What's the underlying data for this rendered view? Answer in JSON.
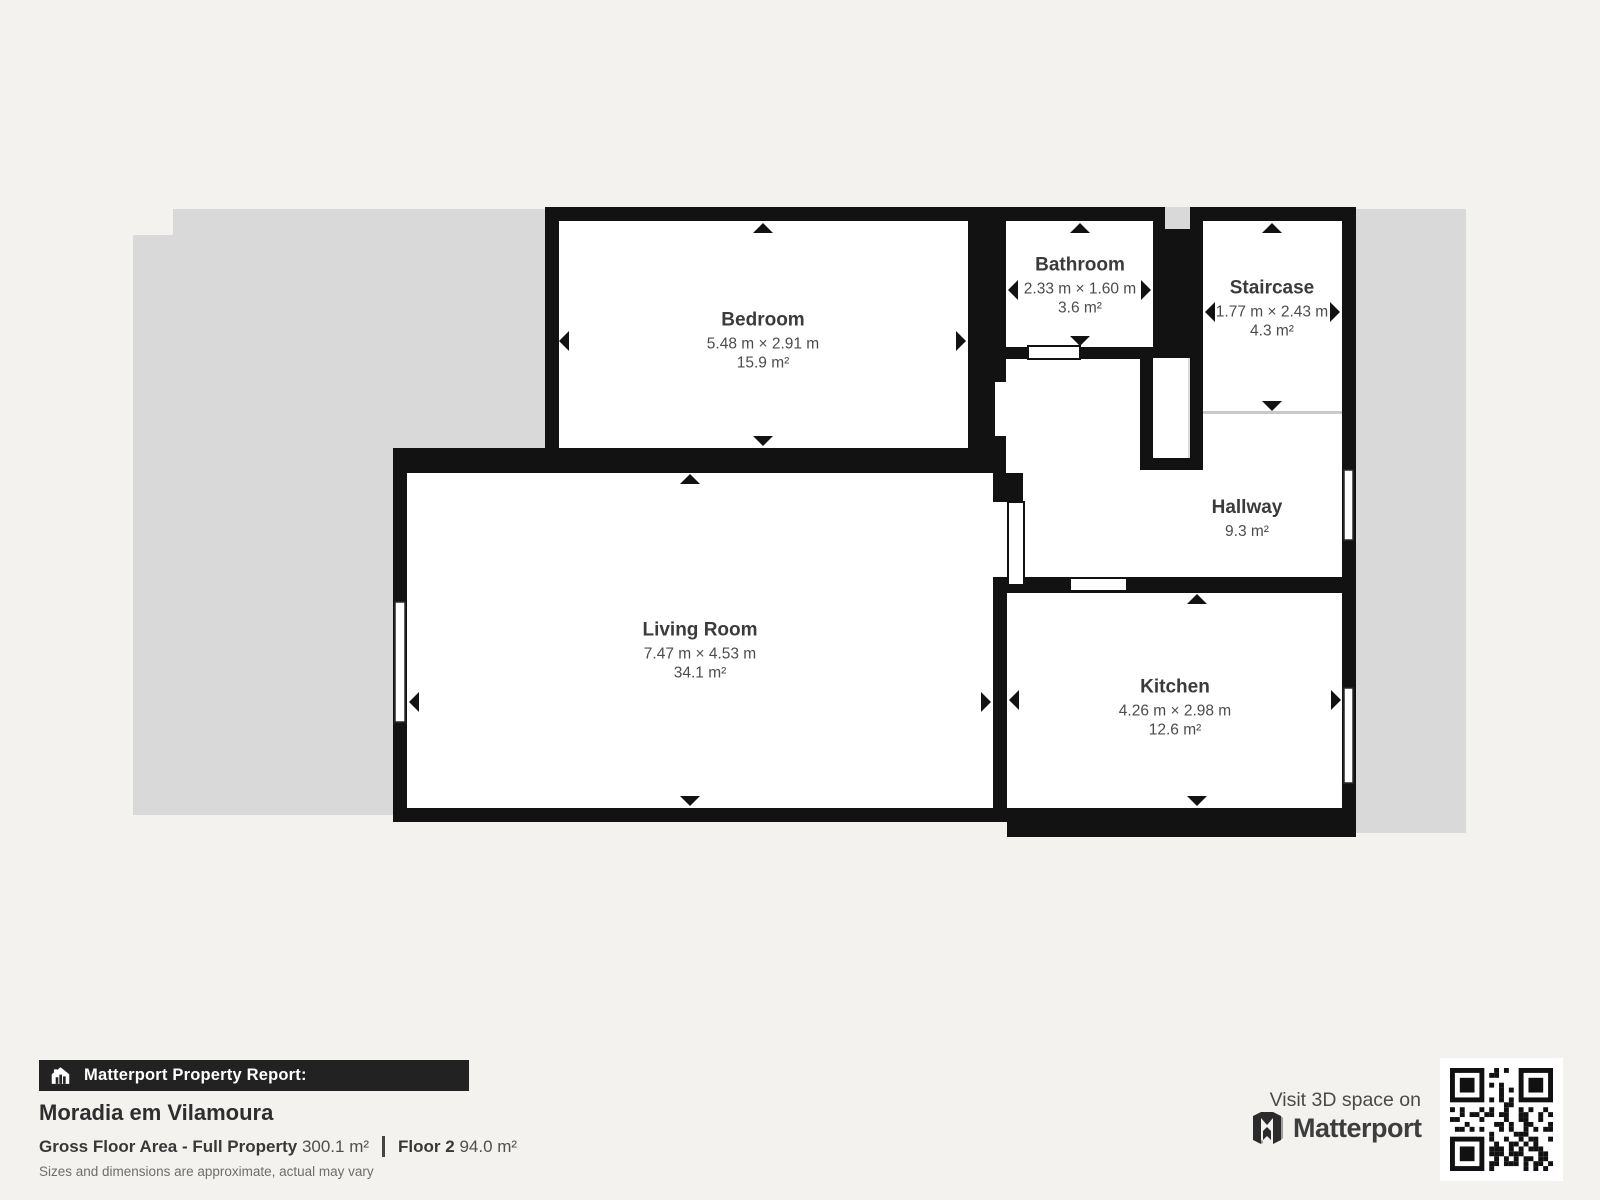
{
  "plan": {
    "rooms": [
      {
        "name": "Bedroom",
        "dims": "5.48 m × 2.91 m",
        "area": "15.9 m²"
      },
      {
        "name": "Bathroom",
        "dims": "2.33 m × 1.60 m",
        "area": "3.6 m²"
      },
      {
        "name": "Staircase",
        "dims": "1.77 m × 2.43 m",
        "area": "4.3 m²"
      },
      {
        "name": "Hallway",
        "area": "9.3 m²"
      },
      {
        "name": "Living Room",
        "dims": "7.47 m × 4.53 m",
        "area": "34.1 m²"
      },
      {
        "name": "Kitchen",
        "dims": "4.26 m × 2.98 m",
        "area": "12.6 m²"
      }
    ]
  },
  "footer": {
    "report_label": "Matterport Property Report:",
    "property_name": "Moradia em Vilamoura",
    "gross_floor_label": "Gross Floor Area - Full Property",
    "gross_floor_value": "300.1 m²",
    "floor_label": "Floor 2",
    "floor_value": "94.0 m²",
    "disclaimer": "Sizes and dimensions are approximate, actual may vary",
    "visit_label": "Visit 3D space on",
    "brand_name": "Matterport"
  },
  "colors": {
    "wall": "#121212",
    "floor": "#ffffff",
    "property_silhouette": "#d9d9d9",
    "background": "#f3f2ef",
    "report_bar": "#222222"
  }
}
